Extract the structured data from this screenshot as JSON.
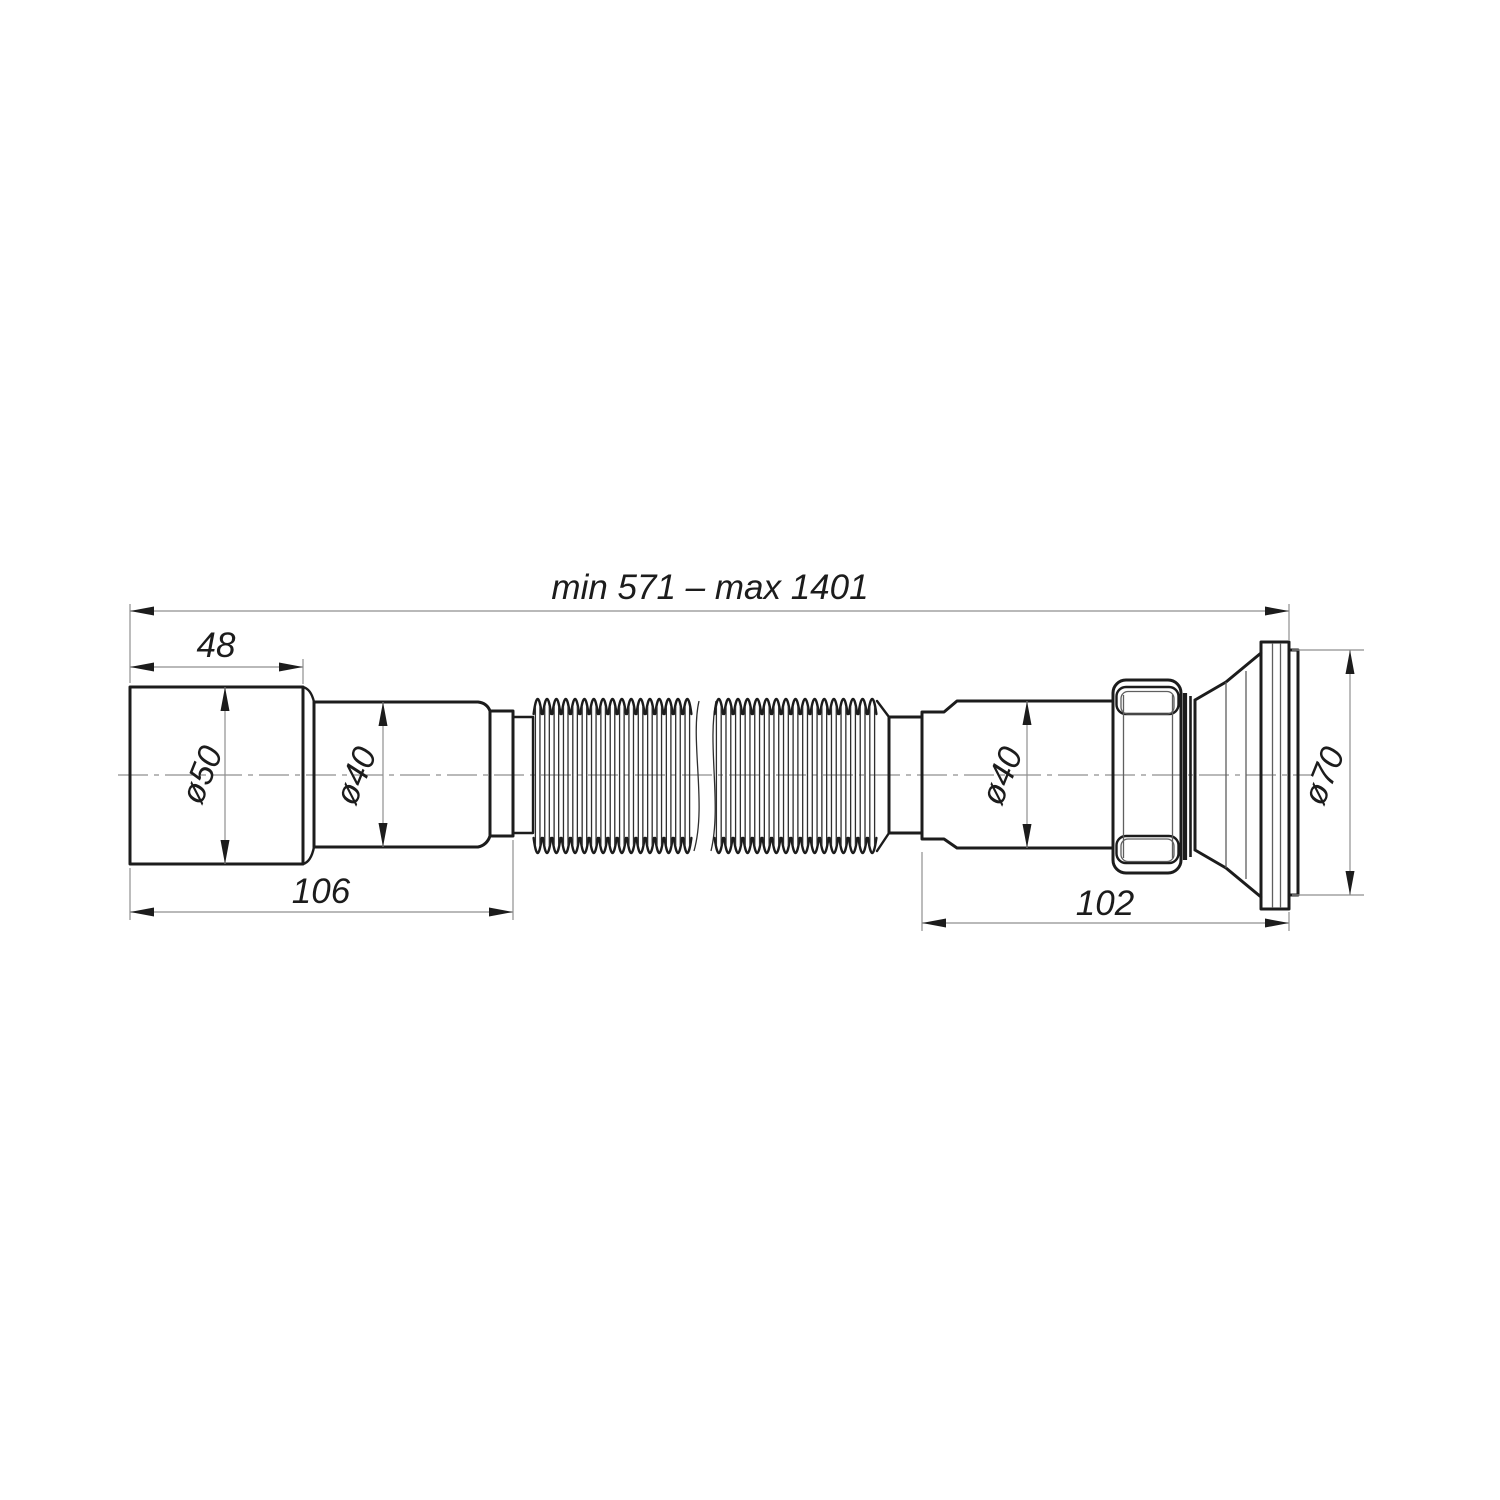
{
  "colors": {
    "background": "#ffffff",
    "outline": "#1c1c1c",
    "dim_line": "#8f8f8f"
  },
  "dimensions": {
    "overall_length": "min 571 – max 1401",
    "inlet_depth": "48",
    "inlet_diameter": "ø50",
    "left_pipe_diameter": "ø40",
    "left_end_length": "106",
    "right_pipe_diameter": "ø40",
    "right_end_length": "102",
    "outlet_diameter": "ø70"
  }
}
